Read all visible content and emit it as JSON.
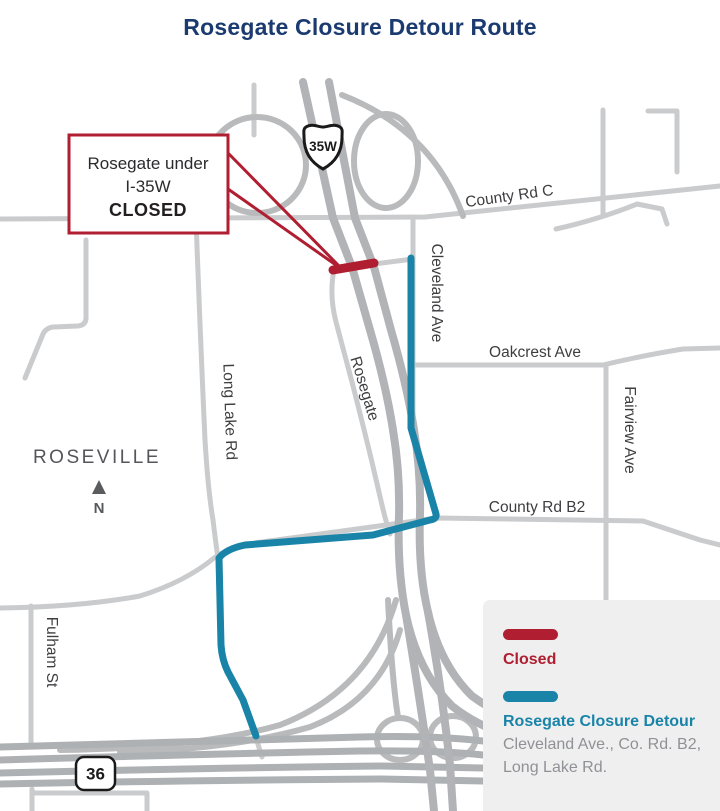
{
  "title": "Rosegate Closure Detour Route",
  "callout": {
    "line1": "Rosegate under",
    "line2": "I-35W",
    "line3": "CLOSED"
  },
  "shields": {
    "interstate_35w": "35W",
    "highway_36": "36"
  },
  "map_labels": {
    "county_rd_c": "County Rd C",
    "cleveland_ave": "Cleveland Ave",
    "oakcrest_ave": "Oakcrest Ave",
    "fairview_ave": "Fairview Ave",
    "county_rd_b2": "County Rd B2",
    "long_lake_rd": "Long Lake Rd",
    "rosegate": "Rosegate",
    "fulham_st": "Fulham St",
    "roseville": "ROSEVILLE",
    "north": "N"
  },
  "legend": {
    "closed_label": "Closed",
    "detour_label": "Rosegate Closure Detour",
    "detour_desc_line1": "Cleveland Ave., Co. Rd. B2,",
    "detour_desc_line2": "Long Lake Rd."
  },
  "colors": {
    "closed_red": "#b01e31",
    "detour_teal": "#1a84a8",
    "title_navy": "#1b3a6f",
    "legend_bg": "#efeff0",
    "road_gray": "#c9cbcd",
    "freeway_gray": "#b1b3b6"
  }
}
